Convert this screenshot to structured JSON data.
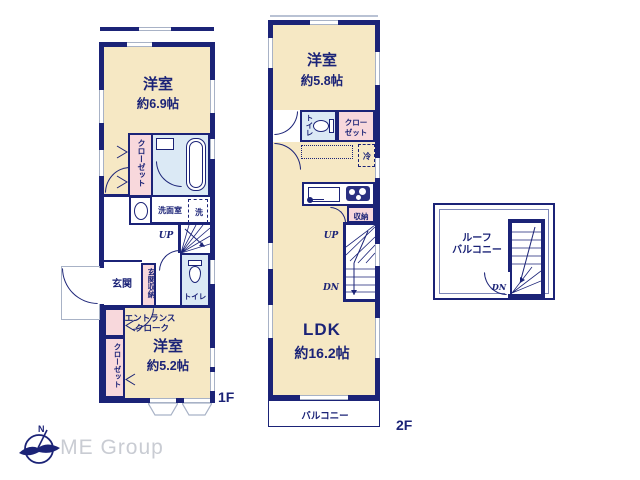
{
  "colors": {
    "wall_navy": "#1b2377",
    "room_cream": "#f6e8c4",
    "closet_pink": "#f8d8dc",
    "sanitary_blue": "#dbe9f5",
    "window_gray": "#a8b2c6",
    "logo_gray": "#c9ccd3"
  },
  "floor1": {
    "label": "1F",
    "bedroom_top": {
      "name": "洋室",
      "size": "約6.9帖"
    },
    "bedroom_bottom": {
      "name": "洋室",
      "size": "約5.2帖"
    },
    "closet_top": "クローゼット",
    "closet_bottom": "クローゼット",
    "washroom": "洗面室",
    "washer": "洗",
    "up": "UP",
    "toilet": "トイレ",
    "entrance": "玄関",
    "entrance_storage": "玄関収納",
    "entrance_cloak": [
      "エントランス",
      "クローク"
    ]
  },
  "floor2": {
    "label": "2F",
    "bedroom": {
      "name": "洋室",
      "size": "約5.8帖"
    },
    "toilet": "トイレ",
    "closet": [
      "クロー",
      "ゼット"
    ],
    "fridge": "冷",
    "storage": "収納",
    "up": "UP",
    "dn": "DN",
    "ldk": {
      "name": "LDK",
      "size": "約16.2帖"
    },
    "balcony": "バルコニー"
  },
  "roof": {
    "label": [
      "ルーフ",
      "バルコニー"
    ],
    "dn": "DN"
  },
  "logo": {
    "company": "ME Group",
    "compass_letter": "N"
  }
}
